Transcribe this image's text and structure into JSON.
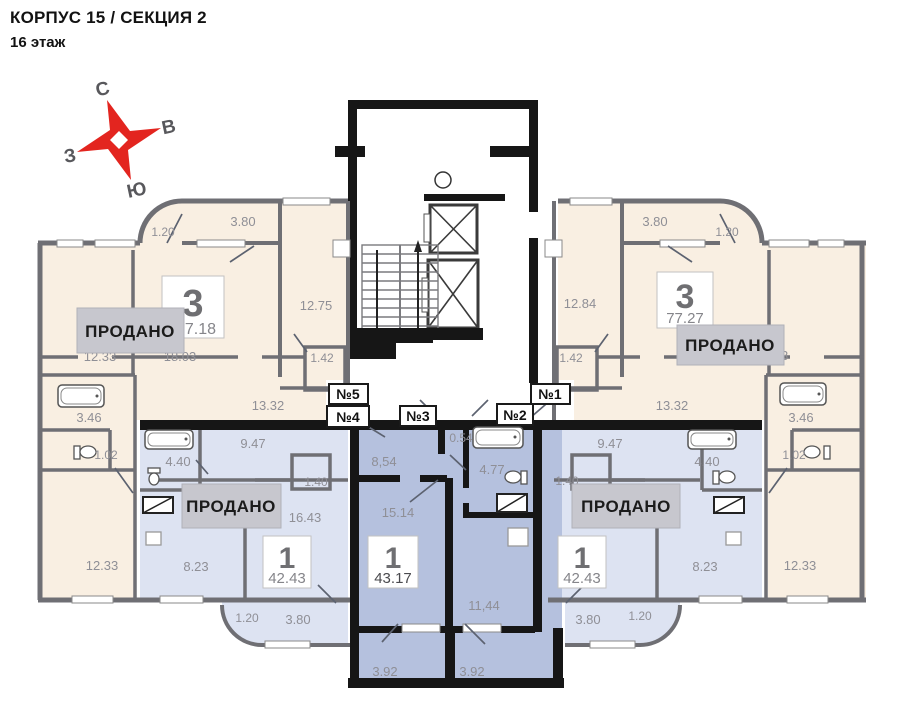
{
  "header": {
    "title": "КОРПУС 15 / СЕКЦИЯ 2",
    "subtitle": "16 этаж"
  },
  "compass": {
    "north": "С",
    "east": "В",
    "west": "З",
    "south": "Ю",
    "color": "#e3251f"
  },
  "labels": {
    "sold": "ПРОДАНО"
  },
  "units": {
    "u1": "№1",
    "u2": "№2",
    "u3": "№3",
    "u4": "№4",
    "u5": "№5"
  },
  "apartments": {
    "left3": {
      "rooms": "3",
      "total": "77.18",
      "dims": {
        "balc_small": "1.20",
        "balc": "3.80",
        "room_top": "12.75",
        "room_a": "12.33",
        "room_b": "18.03",
        "storage": "1.42",
        "hall": "13.32",
        "bath": "3.46",
        "wc": "1.02",
        "bedroom": "12.33"
      }
    },
    "left1": {
      "rooms": "1",
      "total": "42.43",
      "dims": {
        "hall": "9.47",
        "bath": "4.40",
        "wc": "1.40",
        "living": "16.43",
        "kitchen": "8.23",
        "balc_small": "1.20",
        "balc": "3.80"
      }
    },
    "center1": {
      "rooms": "1",
      "total": "43.17",
      "dims": {
        "niche": "0.54",
        "hall": "8,54",
        "bath": "4.77",
        "room": "15.14",
        "kitchen": "11,44",
        "balc_a": "3.92",
        "balc_b": "3.92"
      }
    },
    "right1": {
      "rooms": "1",
      "total": "42.43",
      "dims": {
        "hall": "9.47",
        "bath": "4.40",
        "wc": "1.40",
        "living": "16.43",
        "kitchen": "8.23",
        "balc_small": "1.20",
        "balc": "3.80"
      }
    },
    "right3": {
      "rooms": "3",
      "total": "77.27",
      "dims": {
        "balc_small": "1.20",
        "balc": "3.80",
        "room_top": "12.84",
        "room_b": "18.33",
        "storage": "1.42",
        "hall": "13.32",
        "bath": "3.46",
        "wc": "1.02",
        "bedroom": "12.33"
      }
    }
  },
  "palette": {
    "beige": "#f9efe2",
    "blue": "#dde3f2",
    "highlight": "#b5c1de",
    "wall_gray": "#6f6f74",
    "wall_black": "#161616",
    "banner": "#c7c7ce"
  }
}
